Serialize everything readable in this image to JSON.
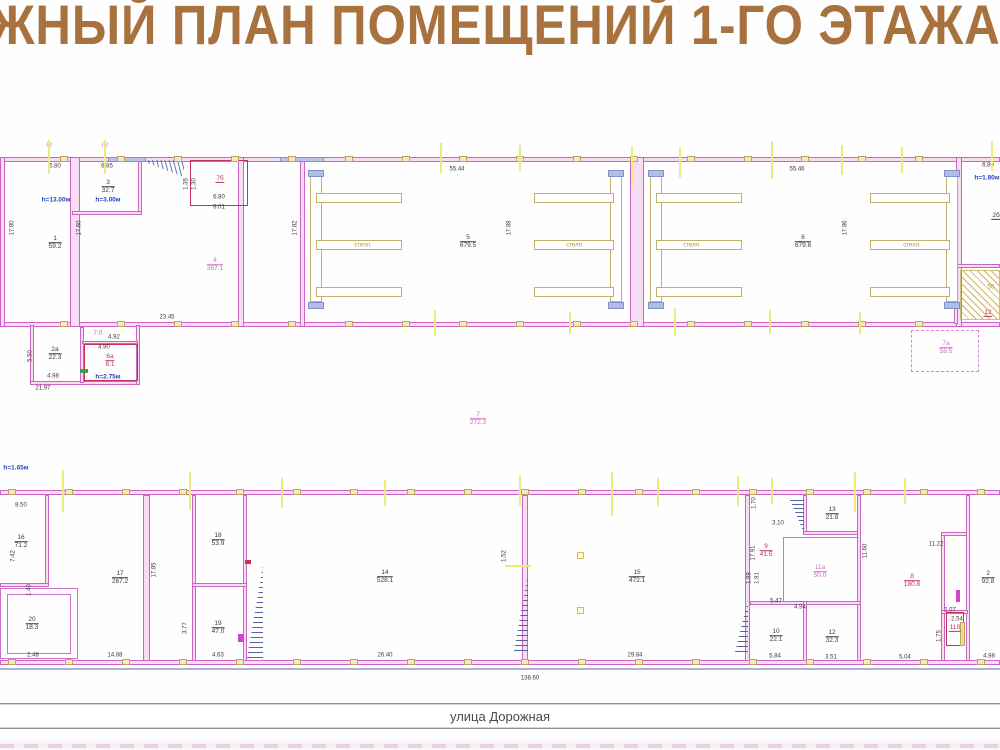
{
  "title": "ЖНЫЙ ПЛАН ПОМЕЩЕНИЙ 1-ГО ЭТАЖА",
  "title_color": "#a8723e",
  "street": {
    "label": "улица Дорожная"
  },
  "colors": {
    "wall_magenta": "#ca65c4",
    "red_outline": "#c5305a",
    "tan_structure": "#c3b06e",
    "axis_yellow": "#ecec7e",
    "annotation_blue": "#2b3fbf",
    "label_pink": "#d06cc6"
  },
  "labels": [
    {
      "k": "dim",
      "t": "6.80",
      "x": 55,
      "y": 167
    },
    {
      "k": "dim",
      "t": "6.85",
      "x": 107,
      "y": 167
    },
    {
      "k": "dim",
      "t": "17.80",
      "x": 13,
      "y": 228,
      "r": -90
    },
    {
      "k": "dim",
      "t": "17.60",
      "x": 80,
      "y": 228,
      "r": -90
    },
    {
      "k": "dim",
      "t": "1.35",
      "x": 187,
      "y": 184,
      "r": -90
    },
    {
      "k": "dim",
      "t": "1.30",
      "x": 195,
      "y": 184,
      "r": -90
    },
    {
      "k": "dim",
      "t": "6.80",
      "x": 219,
      "y": 198
    },
    {
      "k": "dim",
      "t": "6.01",
      "x": 219,
      "y": 208
    },
    {
      "k": "dim",
      "t": "55.44",
      "x": 457,
      "y": 170
    },
    {
      "k": "dim",
      "t": "17.82",
      "x": 296,
      "y": 228,
      "r": -90
    },
    {
      "k": "dim",
      "t": "17.88",
      "x": 510,
      "y": 228,
      "r": -90
    },
    {
      "k": "dim",
      "t": "55.46",
      "x": 797,
      "y": 170
    },
    {
      "k": "dim",
      "t": "17.86",
      "x": 846,
      "y": 228,
      "r": -90
    },
    {
      "k": "dim",
      "t": "23.45",
      "x": 167,
      "y": 318
    },
    {
      "k": "dim",
      "t": "4.90",
      "x": 104,
      "y": 348
    },
    {
      "k": "dim",
      "t": "4.92",
      "x": 114,
      "y": 338
    },
    {
      "k": "dim",
      "t": "4.98",
      "x": 53,
      "y": 377
    },
    {
      "k": "dim",
      "t": "21.97",
      "x": 43,
      "y": 389
    },
    {
      "k": "dim",
      "t": "5.50",
      "x": 31,
      "y": 356,
      "r": -90
    },
    {
      "k": "dim",
      "t": "6.80",
      "x": 988,
      "y": 166
    },
    {
      "k": "tan",
      "t": "50",
      "x": 991,
      "y": 288
    },
    {
      "k": "room",
      "n": "1",
      "a": "59.2",
      "x": 55,
      "y": 243
    },
    {
      "k": "room",
      "n": "3",
      "a": "32.7",
      "x": 108,
      "y": 187
    },
    {
      "k": "room",
      "n": "4",
      "a": "387.1",
      "x": 215,
      "y": 265,
      "c": "pink"
    },
    {
      "k": "room",
      "n": "5",
      "a": "679.5",
      "x": 468,
      "y": 242
    },
    {
      "k": "room",
      "n": "6",
      "a": "679.8",
      "x": 803,
      "y": 242
    },
    {
      "k": "room",
      "n": "7б",
      "a": "",
      "x": 220,
      "y": 179,
      "c": "red"
    },
    {
      "k": "room",
      "n": "2а",
      "a": "22.3",
      "x": 55,
      "y": 354
    },
    {
      "k": "room",
      "n": "6а",
      "a": "8.1",
      "x": 110,
      "y": 361,
      "c": "red"
    },
    {
      "k": "pink",
      "t": "7.б",
      "x": 98,
      "y": 333
    },
    {
      "k": "room",
      "n": "7а",
      "a": "58.5",
      "x": 946,
      "y": 348,
      "c": "pink"
    },
    {
      "k": "room",
      "n": "12",
      "a": "",
      "x": 988,
      "y": 313,
      "c": "red"
    },
    {
      "k": "room",
      "n": "2б",
      "a": "",
      "x": 996,
      "y": 216
    },
    {
      "k": "room",
      "n": "7",
      "a": "272.3",
      "x": 478,
      "y": 419,
      "c": "pink"
    },
    {
      "k": "blue",
      "t": "h=13.00м",
      "x": 56,
      "y": 200
    },
    {
      "k": "blue",
      "t": "h=3.00м",
      "x": 108,
      "y": 200
    },
    {
      "k": "blue",
      "t": "h=2.75м",
      "x": 108,
      "y": 377
    },
    {
      "k": "blue",
      "t": "h=1.80м",
      "x": 987,
      "y": 178
    },
    {
      "k": "axis",
      "t": "III",
      "x": 49,
      "y": 146
    },
    {
      "k": "axis",
      "t": "IV",
      "x": 105,
      "y": 146
    },
    {
      "k": "axis",
      "t": "1",
      "x": 992,
      "y": 146
    },
    {
      "k": "tan",
      "t": "стелл.",
      "x": 363,
      "y": 246
    },
    {
      "k": "tan",
      "t": "стелл.",
      "x": 575,
      "y": 246
    },
    {
      "k": "tan",
      "t": "стелл.",
      "x": 692,
      "y": 246
    },
    {
      "k": "tan",
      "t": "стелл.",
      "x": 912,
      "y": 246
    },
    {
      "k": "blue",
      "t": "h=1.65м",
      "x": 16,
      "y": 468
    },
    {
      "k": "dim",
      "t": "8.50",
      "x": 21,
      "y": 506
    },
    {
      "k": "dim",
      "t": "7.42",
      "x": 14,
      "y": 556,
      "r": -90
    },
    {
      "k": "dim",
      "t": "1.40",
      "x": 30,
      "y": 590,
      "r": -90
    },
    {
      "k": "dim",
      "t": "2.48",
      "x": 33,
      "y": 656
    },
    {
      "k": "dim",
      "t": "14.88",
      "x": 115,
      "y": 656
    },
    {
      "k": "dim",
      "t": "17.85",
      "x": 155,
      "y": 570,
      "r": -90
    },
    {
      "k": "dim",
      "t": "3.77",
      "x": 186,
      "y": 628,
      "r": -90
    },
    {
      "k": "dim",
      "t": "4.63",
      "x": 218,
      "y": 656
    },
    {
      "k": "dim",
      "t": "26.40",
      "x": 385,
      "y": 656
    },
    {
      "k": "dim",
      "t": "29.84",
      "x": 635,
      "y": 656
    },
    {
      "k": "dim",
      "t": "1.52",
      "x": 505,
      "y": 556,
      "r": -90
    },
    {
      "k": "dim",
      "t": "3.10",
      "x": 778,
      "y": 524
    },
    {
      "k": "dim",
      "t": "1.70",
      "x": 755,
      "y": 503,
      "r": -90
    },
    {
      "k": "dim",
      "t": "17.91",
      "x": 754,
      "y": 553,
      "r": -90
    },
    {
      "k": "dim",
      "t": "1.98",
      "x": 750,
      "y": 578,
      "r": -90
    },
    {
      "k": "dim",
      "t": "1.91",
      "x": 758,
      "y": 578,
      "r": -90
    },
    {
      "k": "dim",
      "t": "5.47",
      "x": 776,
      "y": 602
    },
    {
      "k": "dim",
      "t": "4.94",
      "x": 800,
      "y": 608
    },
    {
      "k": "dim",
      "t": "11.60",
      "x": 866,
      "y": 551,
      "r": -90
    },
    {
      "k": "dim",
      "t": "11.22",
      "x": 936,
      "y": 545
    },
    {
      "k": "dim",
      "t": "2.07",
      "x": 950,
      "y": 611
    },
    {
      "k": "dim",
      "t": "2.54",
      "x": 957,
      "y": 620
    },
    {
      "k": "dim",
      "t": "1.75",
      "x": 940,
      "y": 636,
      "r": -90
    },
    {
      "k": "dim",
      "t": "5.84",
      "x": 775,
      "y": 657
    },
    {
      "k": "dim",
      "t": "3.51",
      "x": 831,
      "y": 658
    },
    {
      "k": "dim",
      "t": "5.04",
      "x": 905,
      "y": 658
    },
    {
      "k": "dim",
      "t": "4.98",
      "x": 989,
      "y": 657
    },
    {
      "k": "room",
      "n": "16",
      "a": "71.2",
      "x": 21,
      "y": 542
    },
    {
      "k": "room",
      "n": "17",
      "a": "267.2",
      "x": 120,
      "y": 578
    },
    {
      "k": "room",
      "n": "18",
      "a": "53.9",
      "x": 218,
      "y": 540
    },
    {
      "k": "room",
      "n": "19",
      "a": "47.0",
      "x": 218,
      "y": 628
    },
    {
      "k": "room",
      "n": "14",
      "a": "528.1",
      "x": 385,
      "y": 577
    },
    {
      "k": "room",
      "n": "15",
      "a": "472.1",
      "x": 637,
      "y": 577
    },
    {
      "k": "room",
      "n": "9",
      "a": "41.5",
      "x": 766,
      "y": 551,
      "c": "red"
    },
    {
      "k": "room",
      "n": "13",
      "a": "21.8",
      "x": 832,
      "y": 514
    },
    {
      "k": "room",
      "n": "11а",
      "a": "50.0",
      "x": 820,
      "y": 572,
      "c": "pink"
    },
    {
      "k": "room",
      "n": "8",
      "a": "180.8",
      "x": 912,
      "y": 581,
      "c": "red"
    },
    {
      "k": "room",
      "n": "10",
      "a": "22.1",
      "x": 776,
      "y": 636
    },
    {
      "k": "room",
      "n": "12",
      "a": "32.3",
      "x": 832,
      "y": 637
    },
    {
      "k": "room",
      "n": "11б",
      "a": "",
      "x": 955,
      "y": 628,
      "c": "red"
    },
    {
      "k": "room",
      "n": "2",
      "a": "92.8",
      "x": 988,
      "y": 578
    },
    {
      "k": "room",
      "n": "20",
      "a": "18.3",
      "x": 32,
      "y": 624
    },
    {
      "k": "dim",
      "t": "138.60",
      "x": 530,
      "y": 679
    }
  ],
  "column_rows": [
    {
      "y": 159,
      "x0": 64,
      "x1": 975,
      "step": 57
    },
    {
      "y": 324,
      "x0": 64,
      "x1": 975,
      "step": 57
    },
    {
      "y": 492,
      "x0": 12,
      "x1": 985,
      "step": 57
    },
    {
      "y": 662,
      "x0": 12,
      "x1": 985,
      "step": 57
    }
  ],
  "yellow_ticks": [
    {
      "x": 49,
      "y": 140,
      "h": 34
    },
    {
      "x": 105,
      "y": 140,
      "h": 34
    },
    {
      "x": 441,
      "y": 143,
      "h": 30
    },
    {
      "x": 520,
      "y": 145,
      "h": 26
    },
    {
      "x": 632,
      "y": 146,
      "h": 40
    },
    {
      "x": 680,
      "y": 148,
      "h": 30
    },
    {
      "x": 772,
      "y": 141,
      "h": 38
    },
    {
      "x": 842,
      "y": 145,
      "h": 30
    },
    {
      "x": 902,
      "y": 147,
      "h": 26
    },
    {
      "x": 992,
      "y": 141,
      "h": 30
    },
    {
      "x": 435,
      "y": 310,
      "h": 26
    },
    {
      "x": 570,
      "y": 312,
      "h": 22
    },
    {
      "x": 675,
      "y": 308,
      "h": 28
    },
    {
      "x": 770,
      "y": 310,
      "h": 24
    },
    {
      "x": 860,
      "y": 312,
      "h": 22
    },
    {
      "x": 63,
      "y": 470,
      "h": 42
    },
    {
      "x": 190,
      "y": 472,
      "h": 38
    },
    {
      "x": 282,
      "y": 478,
      "h": 30
    },
    {
      "x": 385,
      "y": 480,
      "h": 26
    },
    {
      "x": 520,
      "y": 476,
      "h": 30
    },
    {
      "x": 612,
      "y": 472,
      "h": 44
    },
    {
      "x": 658,
      "y": 478,
      "h": 28
    },
    {
      "x": 738,
      "y": 476,
      "h": 30
    },
    {
      "x": 772,
      "y": 478,
      "h": 26
    },
    {
      "x": 855,
      "y": 472,
      "h": 40
    },
    {
      "x": 905,
      "y": 478,
      "h": 26
    }
  ]
}
